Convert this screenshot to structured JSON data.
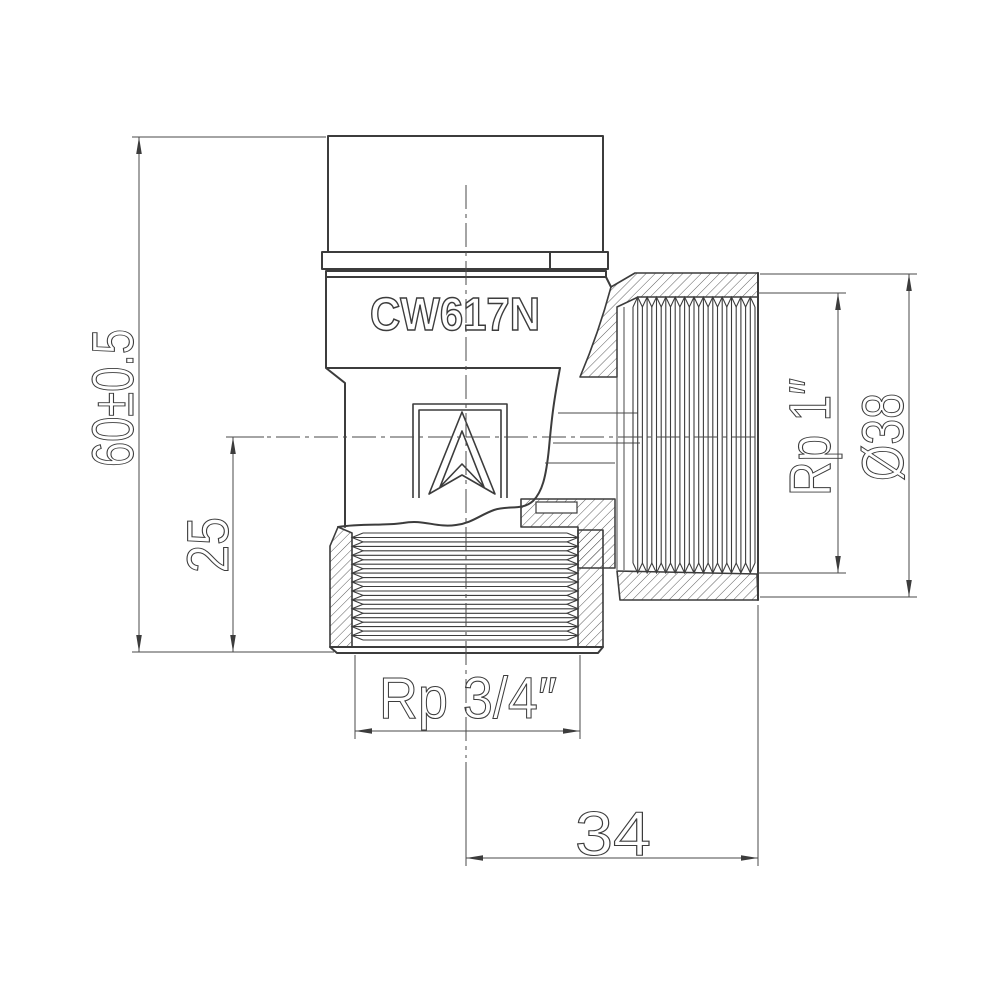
{
  "colors": {
    "line": "#3c3c3c",
    "background": "#ffffff"
  },
  "marking": {
    "material_code": "CW617N"
  },
  "dimensions": {
    "overall_height": "60±0.5",
    "axis_to_bottom_face": "25",
    "side_port_thread": "Rp 1″",
    "side_port_diameter": "Ø38",
    "bottom_port_thread": "Rp 3/4″",
    "axis_to_side_face": "34"
  }
}
